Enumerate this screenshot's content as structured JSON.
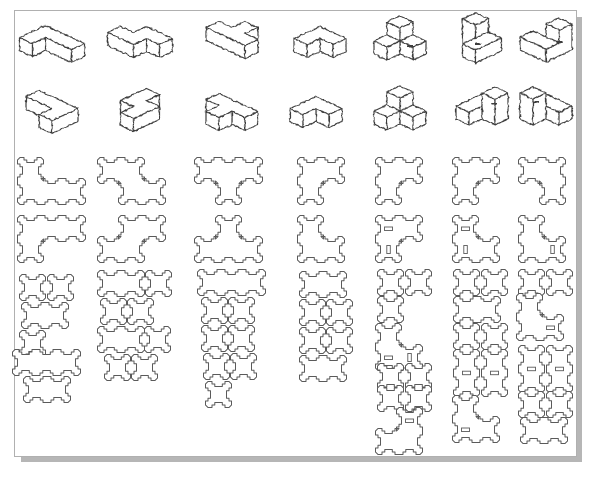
{
  "title": "",
  "style": {
    "line_color": "#3d3d3d",
    "flat_line_color": "#5a5a5a",
    "border_color": "#b0b0b0",
    "shadow_color": "#b6b6b6",
    "background": "#ffffff",
    "iso_stroke_width": 1.2,
    "flat_stroke_width": 1.0,
    "proj": {
      "ax": 13,
      "ay": 6,
      "az": 13
    },
    "flat": {
      "unit": 21,
      "tab": 2.5,
      "corner": 4,
      "notch": 7.5
    }
  },
  "sheet": {
    "x": 14,
    "y": 10,
    "w": 561,
    "h": 445
  },
  "iso_pieces": [
    {
      "name": "iso-piece-1-view-1",
      "cx": 52,
      "cy": 44,
      "cubes": [
        [
          0,
          0,
          0
        ],
        [
          1,
          0,
          0
        ],
        [
          2,
          0,
          0
        ],
        [
          0,
          1,
          0
        ]
      ]
    },
    {
      "name": "iso-piece-2-view-1",
      "cx": 140,
      "cy": 42,
      "cubes": [
        [
          1,
          0,
          0
        ],
        [
          2,
          0,
          0
        ],
        [
          0,
          1,
          0
        ],
        [
          1,
          1,
          0
        ]
      ]
    },
    {
      "name": "iso-piece-3-view-1",
      "cx": 232,
      "cy": 40,
      "cubes": [
        [
          0,
          1,
          0
        ],
        [
          1,
          1,
          0
        ],
        [
          2,
          1,
          0
        ],
        [
          1,
          0,
          0
        ]
      ]
    },
    {
      "name": "iso-piece-4-view-1",
      "cx": 320,
      "cy": 42,
      "cubes": [
        [
          0,
          0,
          0
        ],
        [
          1,
          0,
          0
        ],
        [
          0,
          1,
          0
        ]
      ]
    },
    {
      "name": "iso-piece-5-view-1",
      "cx": 400,
      "cy": 38,
      "cubes": [
        [
          0,
          0,
          0
        ],
        [
          1,
          0,
          0
        ],
        [
          0,
          1,
          0
        ],
        [
          0,
          0,
          1
        ]
      ],
      "dashes": [
        [
          10,
          8,
          6,
          2
        ]
      ]
    },
    {
      "name": "iso-piece-6-view-1",
      "cx": 482,
      "cy": 38,
      "cubes": [
        [
          0,
          0,
          0
        ],
        [
          0,
          0,
          1
        ],
        [
          1,
          0,
          0
        ],
        [
          1,
          1,
          0
        ]
      ],
      "dashes": [
        [
          -4,
          6,
          6,
          2
        ]
      ]
    },
    {
      "name": "iso-piece-7-view-1",
      "cx": 546,
      "cy": 40,
      "cubes": [
        [
          0,
          1,
          0
        ],
        [
          1,
          1,
          0
        ],
        [
          1,
          0,
          0
        ],
        [
          1,
          0,
          1
        ]
      ],
      "dashes": [
        [
          14,
          2,
          6,
          2
        ]
      ]
    },
    {
      "name": "iso-piece-1-view-2",
      "cx": 52,
      "cy": 112,
      "cubes": [
        [
          0,
          0,
          0
        ],
        [
          1,
          0,
          0
        ],
        [
          2,
          0,
          0
        ],
        [
          2,
          1,
          0
        ]
      ]
    },
    {
      "name": "iso-piece-2-view-2",
      "cx": 140,
      "cy": 110,
      "cubes": [
        [
          0,
          0,
          0
        ],
        [
          0,
          1,
          0
        ],
        [
          1,
          1,
          0
        ],
        [
          1,
          2,
          0
        ]
      ]
    },
    {
      "name": "iso-piece-3-view-2",
      "cx": 232,
      "cy": 112,
      "cubes": [
        [
          0,
          0,
          0
        ],
        [
          1,
          0,
          0
        ],
        [
          2,
          0,
          0
        ],
        [
          1,
          1,
          0
        ]
      ]
    },
    {
      "name": "iso-piece-4-view-2",
      "cx": 316,
      "cy": 112,
      "cubes": [
        [
          1,
          0,
          0
        ],
        [
          0,
          0,
          0
        ],
        [
          0,
          1,
          0
        ]
      ]
    },
    {
      "name": "iso-piece-5-view-2",
      "cx": 400,
      "cy": 108,
      "cubes": [
        [
          1,
          0,
          0
        ],
        [
          0,
          0,
          0
        ],
        [
          0,
          1,
          0
        ],
        [
          0,
          0,
          1
        ]
      ]
    },
    {
      "name": "iso-piece-6-view-2",
      "cx": 482,
      "cy": 106,
      "cubes": [
        [
          0,
          1,
          0
        ],
        [
          0,
          0,
          0
        ],
        [
          1,
          0,
          0
        ],
        [
          1,
          0,
          1
        ]
      ],
      "dashes": [
        [
          12,
          -2,
          6,
          2
        ]
      ]
    },
    {
      "name": "iso-piece-7-view-2",
      "cx": 546,
      "cy": 106,
      "cubes": [
        [
          1,
          0,
          0
        ],
        [
          0,
          0,
          0
        ],
        [
          0,
          1,
          0
        ],
        [
          0,
          1,
          1
        ]
      ],
      "dashes": [
        [
          -10,
          -4,
          6,
          2
        ]
      ]
    }
  ],
  "flat_panels": [
    {
      "name": "panel-1-face-a",
      "x": 20,
      "y": 160,
      "cells": [
        [
          0,
          0
        ],
        [
          0,
          1
        ],
        [
          1,
          1
        ],
        [
          2,
          1
        ]
      ]
    },
    {
      "name": "panel-1-face-b",
      "x": 20,
      "y": 218,
      "cells": [
        [
          0,
          0
        ],
        [
          1,
          0
        ],
        [
          2,
          0
        ],
        [
          0,
          1
        ]
      ]
    },
    {
      "name": "panel-1-sq-1",
      "x": 22,
      "y": 277,
      "cells": [
        [
          0,
          0
        ]
      ]
    },
    {
      "name": "panel-1-sq-2",
      "x": 50,
      "y": 277,
      "cells": [
        [
          0,
          0
        ]
      ]
    },
    {
      "name": "panel-1-strip-2a",
      "x": 24,
      "y": 305,
      "cells": [
        [
          0,
          0
        ],
        [
          1,
          0
        ]
      ]
    },
    {
      "name": "panel-1-sq-3",
      "x": 22,
      "y": 333,
      "cells": [
        [
          0,
          0
        ]
      ]
    },
    {
      "name": "panel-1-strip-3",
      "x": 15,
      "y": 352,
      "cells": [
        [
          0,
          0
        ],
        [
          1,
          0
        ],
        [
          2,
          0
        ]
      ]
    },
    {
      "name": "panel-1-strip-2b",
      "x": 26,
      "y": 379,
      "cells": [
        [
          0,
          0
        ],
        [
          1,
          0
        ]
      ]
    },
    {
      "name": "panel-2-face-a",
      "x": 100,
      "y": 160,
      "cells": [
        [
          0,
          0
        ],
        [
          1,
          0
        ],
        [
          1,
          1
        ],
        [
          2,
          1
        ]
      ]
    },
    {
      "name": "panel-2-face-b",
      "x": 100,
      "y": 218,
      "cells": [
        [
          1,
          0
        ],
        [
          2,
          0
        ],
        [
          0,
          1
        ],
        [
          1,
          1
        ]
      ]
    },
    {
      "name": "panel-2-strip-2a",
      "x": 100,
      "y": 273,
      "cells": [
        [
          0,
          0
        ],
        [
          1,
          0
        ]
      ]
    },
    {
      "name": "panel-2-sq-1",
      "x": 148,
      "y": 273,
      "cells": [
        [
          0,
          0
        ]
      ]
    },
    {
      "name": "panel-2-sq-2",
      "x": 103,
      "y": 301,
      "cells": [
        [
          0,
          0
        ]
      ]
    },
    {
      "name": "panel-2-sq-3",
      "x": 130,
      "y": 301,
      "cells": [
        [
          0,
          0
        ]
      ]
    },
    {
      "name": "panel-2-strip-2b",
      "x": 100,
      "y": 329,
      "cells": [
        [
          0,
          0
        ],
        [
          1,
          0
        ]
      ]
    },
    {
      "name": "panel-2-sq-4",
      "x": 147,
      "y": 329,
      "cells": [
        [
          0,
          0
        ]
      ]
    },
    {
      "name": "panel-2-sq-5",
      "x": 107,
      "y": 357,
      "cells": [
        [
          0,
          0
        ]
      ]
    },
    {
      "name": "panel-2-sq-6",
      "x": 134,
      "y": 357,
      "cells": [
        [
          0,
          0
        ]
      ]
    },
    {
      "name": "panel-3-face-a",
      "x": 197,
      "y": 160,
      "cells": [
        [
          0,
          0
        ],
        [
          1,
          0
        ],
        [
          2,
          0
        ],
        [
          1,
          1
        ]
      ]
    },
    {
      "name": "panel-3-face-b",
      "x": 197,
      "y": 218,
      "cells": [
        [
          1,
          0
        ],
        [
          0,
          1
        ],
        [
          1,
          1
        ],
        [
          2,
          1
        ]
      ]
    },
    {
      "name": "panel-3-strip-3",
      "x": 200,
      "y": 272,
      "cells": [
        [
          0,
          0
        ],
        [
          1,
          0
        ],
        [
          2,
          0
        ]
      ]
    },
    {
      "name": "panel-3-sq-1",
      "x": 204,
      "y": 300,
      "cells": [
        [
          0,
          0
        ]
      ]
    },
    {
      "name": "panel-3-sq-2",
      "x": 231,
      "y": 300,
      "cells": [
        [
          0,
          0
        ]
      ]
    },
    {
      "name": "panel-3-sq-3",
      "x": 204,
      "y": 328,
      "cells": [
        [
          0,
          0
        ]
      ]
    },
    {
      "name": "panel-3-sq-4",
      "x": 231,
      "y": 328,
      "cells": [
        [
          0,
          0
        ]
      ]
    },
    {
      "name": "panel-3-sq-5",
      "x": 206,
      "y": 356,
      "cells": [
        [
          0,
          0
        ]
      ]
    },
    {
      "name": "panel-3-sq-6",
      "x": 233,
      "y": 356,
      "cells": [
        [
          0,
          0
        ]
      ]
    },
    {
      "name": "panel-3-sq-7",
      "x": 208,
      "y": 384,
      "cells": [
        [
          0,
          0
        ]
      ]
    },
    {
      "name": "panel-4-face-a",
      "x": 300,
      "y": 160,
      "cells": [
        [
          0,
          0
        ],
        [
          1,
          0
        ],
        [
          0,
          1
        ]
      ]
    },
    {
      "name": "panel-4-face-b",
      "x": 300,
      "y": 218,
      "cells": [
        [
          0,
          0
        ],
        [
          0,
          1
        ],
        [
          1,
          1
        ]
      ]
    },
    {
      "name": "panel-4-strip-2a",
      "x": 302,
      "y": 274,
      "cells": [
        [
          0,
          0
        ],
        [
          1,
          0
        ]
      ]
    },
    {
      "name": "panel-4-sq-1",
      "x": 302,
      "y": 302,
      "cells": [
        [
          0,
          0
        ]
      ]
    },
    {
      "name": "panel-4-sq-2",
      "x": 329,
      "y": 302,
      "cells": [
        [
          0,
          0
        ]
      ]
    },
    {
      "name": "panel-4-sq-3",
      "x": 302,
      "y": 330,
      "cells": [
        [
          0,
          0
        ]
      ]
    },
    {
      "name": "panel-4-sq-4",
      "x": 329,
      "y": 330,
      "cells": [
        [
          0,
          0
        ]
      ]
    },
    {
      "name": "panel-4-strip-2b",
      "x": 302,
      "y": 358,
      "cells": [
        [
          0,
          0
        ],
        [
          1,
          0
        ]
      ]
    },
    {
      "name": "panel-5-face-a",
      "x": 378,
      "y": 160,
      "cells": [
        [
          0,
          0
        ],
        [
          1,
          0
        ],
        [
          0,
          1
        ]
      ]
    },
    {
      "name": "panel-5-face-b",
      "x": 378,
      "y": 218,
      "cells": [
        [
          0,
          0
        ],
        [
          1,
          0
        ],
        [
          0,
          1
        ]
      ],
      "slots": [
        {
          "x": 6.5,
          "y": 9,
          "w": 8,
          "h": 3.5
        },
        {
          "x": 8.8,
          "y": 27.5,
          "w": 3.5,
          "h": 8
        }
      ]
    },
    {
      "name": "panel-5-sq-1",
      "x": 380,
      "y": 272,
      "cells": [
        [
          0,
          0
        ]
      ]
    },
    {
      "name": "panel-5-sq-2",
      "x": 408,
      "y": 272,
      "cells": [
        [
          0,
          0
        ]
      ]
    },
    {
      "name": "panel-5-sq-3",
      "x": 380,
      "y": 299,
      "cells": [
        [
          0,
          0
        ]
      ]
    },
    {
      "name": "panel-5-corner-a",
      "x": 378,
      "y": 326,
      "cells": [
        [
          0,
          0
        ],
        [
          0,
          1
        ],
        [
          1,
          1
        ]
      ],
      "slots": [
        {
          "x": 6.5,
          "y": 30,
          "w": 8,
          "h": 3.5
        },
        {
          "x": 29.8,
          "y": 27.5,
          "w": 3.5,
          "h": 8
        }
      ]
    },
    {
      "name": "panel-5-sq-4",
      "x": 380,
      "y": 366,
      "cells": [
        [
          0,
          0
        ]
      ]
    },
    {
      "name": "panel-5-sq-5",
      "x": 408,
      "y": 366,
      "cells": [
        [
          0,
          0
        ]
      ]
    },
    {
      "name": "panel-5-sq-6",
      "x": 380,
      "y": 388,
      "cells": [
        [
          0,
          0
        ]
      ]
    },
    {
      "name": "panel-5-sq-7",
      "x": 408,
      "y": 388,
      "cells": [
        [
          0,
          0
        ]
      ]
    },
    {
      "name": "panel-5-corner-b",
      "x": 378,
      "y": 410,
      "cells": [
        [
          1,
          0
        ],
        [
          0,
          1
        ],
        [
          1,
          1
        ]
      ],
      "slots": [
        {
          "x": 27.5,
          "y": 9,
          "w": 8,
          "h": 3.5
        }
      ]
    },
    {
      "name": "panel-6-face-a",
      "x": 455,
      "y": 160,
      "cells": [
        [
          0,
          0
        ],
        [
          1,
          0
        ],
        [
          0,
          1
        ]
      ]
    },
    {
      "name": "panel-6-face-b",
      "x": 455,
      "y": 218,
      "cells": [
        [
          0,
          0
        ],
        [
          0,
          1
        ],
        [
          1,
          1
        ]
      ],
      "slots": [
        {
          "x": 6.5,
          "y": 9,
          "w": 8,
          "h": 3.5
        },
        {
          "x": 8.8,
          "y": 27.5,
          "w": 3.5,
          "h": 8
        }
      ]
    },
    {
      "name": "panel-6-sq-1",
      "x": 456,
      "y": 272,
      "cells": [
        [
          0,
          0
        ]
      ]
    },
    {
      "name": "panel-6-sq-2",
      "x": 484,
      "y": 272,
      "cells": [
        [
          0,
          0
        ]
      ]
    },
    {
      "name": "panel-6-strip-2",
      "x": 456,
      "y": 299,
      "cells": [
        [
          0,
          0
        ],
        [
          1,
          0
        ]
      ]
    },
    {
      "name": "panel-6-sq-3",
      "x": 456,
      "y": 326,
      "cells": [
        [
          0,
          0
        ]
      ]
    },
    {
      "name": "panel-6-sq-4",
      "x": 484,
      "y": 326,
      "cells": [
        [
          0,
          0
        ]
      ]
    },
    {
      "name": "panel-6-post-1",
      "x": 456,
      "y": 352,
      "cells": [
        [
          0,
          0
        ],
        [
          0,
          1
        ]
      ],
      "slots": [
        {
          "x": 6.5,
          "y": 19.2,
          "w": 8,
          "h": 3.5
        }
      ]
    },
    {
      "name": "panel-6-post-2",
      "x": 484,
      "y": 352,
      "cells": [
        [
          0,
          0
        ],
        [
          0,
          1
        ]
      ],
      "slots": [
        {
          "x": 6.5,
          "y": 19.2,
          "w": 8,
          "h": 3.5
        }
      ]
    },
    {
      "name": "panel-6-corner",
      "x": 455,
      "y": 398,
      "cells": [
        [
          0,
          0
        ],
        [
          0,
          1
        ],
        [
          1,
          1
        ]
      ],
      "slots": [
        {
          "x": 6.5,
          "y": 30,
          "w": 8,
          "h": 3.5
        }
      ]
    },
    {
      "name": "panel-7-face-a",
      "x": 521,
      "y": 160,
      "cells": [
        [
          0,
          0
        ],
        [
          1,
          0
        ],
        [
          1,
          1
        ]
      ]
    },
    {
      "name": "panel-7-face-b",
      "x": 521,
      "y": 218,
      "cells": [
        [
          0,
          0
        ],
        [
          0,
          1
        ],
        [
          1,
          1
        ]
      ],
      "slots": [
        {
          "x": 29.8,
          "y": 27.5,
          "w": 3.5,
          "h": 8
        }
      ]
    },
    {
      "name": "panel-7-sq-1",
      "x": 521,
      "y": 272,
      "cells": [
        [
          0,
          0
        ]
      ]
    },
    {
      "name": "panel-7-sq-2",
      "x": 549,
      "y": 272,
      "cells": [
        [
          0,
          0
        ]
      ]
    },
    {
      "name": "panel-7-corner",
      "x": 519,
      "y": 296,
      "cells": [
        [
          0,
          0
        ],
        [
          0,
          1
        ],
        [
          1,
          1
        ]
      ],
      "slots": [
        {
          "x": 27.5,
          "y": 30,
          "w": 8,
          "h": 3.5
        }
      ]
    },
    {
      "name": "panel-7-post-1",
      "x": 521,
      "y": 348,
      "cells": [
        [
          0,
          0
        ],
        [
          0,
          1
        ]
      ],
      "slots": [
        {
          "x": 6.5,
          "y": 19.2,
          "w": 8,
          "h": 3.5
        }
      ]
    },
    {
      "name": "panel-7-post-2",
      "x": 549,
      "y": 348,
      "cells": [
        [
          0,
          0
        ],
        [
          0,
          1
        ]
      ],
      "slots": [
        {
          "x": 6.5,
          "y": 19.2,
          "w": 8,
          "h": 3.5
        }
      ]
    },
    {
      "name": "panel-7-sq-3",
      "x": 521,
      "y": 394,
      "cells": [
        [
          0,
          0
        ]
      ]
    },
    {
      "name": "panel-7-sq-4",
      "x": 549,
      "y": 394,
      "cells": [
        [
          0,
          0
        ]
      ]
    },
    {
      "name": "panel-7-strip-2",
      "x": 523,
      "y": 420,
      "cells": [
        [
          0,
          0
        ],
        [
          1,
          0
        ]
      ]
    }
  ]
}
